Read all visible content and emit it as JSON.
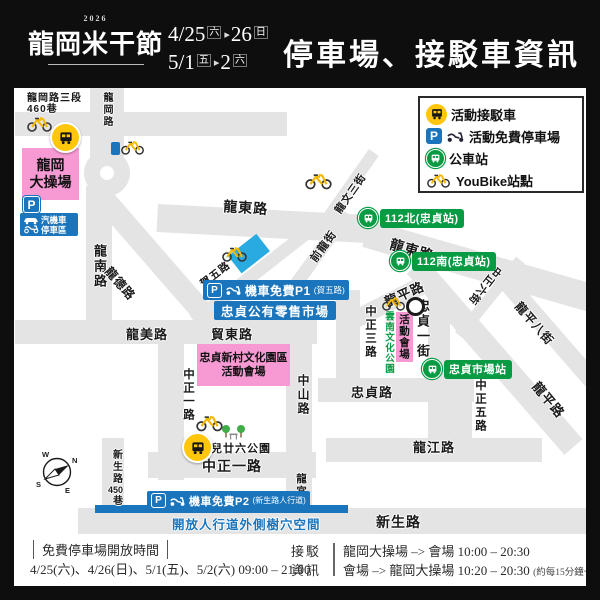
{
  "header": {
    "year": "2026",
    "logo": "龍岡米干節",
    "title": "停車場、接駁車資訊",
    "dates": [
      {
        "d1": "4/25",
        "w1": "六",
        "sep": "▸",
        "d2": "26",
        "w2": "日"
      },
      {
        "d1": "5/1",
        "w1": "五",
        "sep": "▸",
        "d2": "2",
        "w2": "六"
      }
    ]
  },
  "legend": {
    "items": [
      {
        "icon": "shuttle-bus-icon",
        "label": "活動接駁車"
      },
      {
        "icon": "parking-icon",
        "label": "活動免費停車場"
      },
      {
        "icon": "city-bus-icon",
        "label": "公車站"
      },
      {
        "icon": "youbike-icon",
        "label": "YouBike站點"
      }
    ]
  },
  "map": {
    "labels": [
      {
        "text": "龍岡路三段\n460巷"
      },
      {
        "text": "龍岡路"
      },
      {
        "text": "龍南路"
      },
      {
        "text": "龍德路"
      },
      {
        "text": "龍美路"
      },
      {
        "text": "貿東路"
      },
      {
        "text": "賀五路"
      },
      {
        "text": "龍東路"
      },
      {
        "text": "龍東路"
      },
      {
        "text": "前龍街"
      },
      {
        "text": "龍文三街"
      },
      {
        "text": "龍平路"
      },
      {
        "text": "龍平路"
      },
      {
        "text": "龍平八街"
      },
      {
        "text": "中正六街"
      },
      {
        "text": "忠貞一街"
      },
      {
        "text": "中正三路"
      },
      {
        "text": "雲南文化公園"
      },
      {
        "text": "中正五路"
      },
      {
        "text": "忠貞路"
      },
      {
        "text": "龍江路"
      },
      {
        "text": "中山路"
      },
      {
        "text": "中正一路"
      },
      {
        "text": "中正一路"
      },
      {
        "text": "龍宮街"
      },
      {
        "text": "新生路",
        "num": "450",
        "tail": "巷"
      },
      {
        "text": "新生路"
      },
      {
        "text": "兒廿六公園"
      }
    ],
    "badges": [
      {
        "label": "112北(忠貞站)"
      },
      {
        "label": "112南(忠貞站)"
      },
      {
        "label": "忠貞市場站"
      }
    ],
    "areas": {
      "ground": "龍岡\n大操場",
      "vehicle_park": "汽機車\n停車區",
      "culture": "忠貞新村文化園區\n活動會場",
      "venue": "活動會場"
    },
    "banners": {
      "p_letter": "P",
      "p1": "機車免費P1",
      "p1_sub": "(賀五路)",
      "market": "忠貞公有零售市場",
      "p2": "機車免費P2",
      "p2_sub": "(新生路人行道)",
      "sidewalk": "開放人行道外側樹穴空間"
    },
    "compass": {
      "n": "N",
      "e": "E",
      "s": "S",
      "w": "W"
    }
  },
  "footer": {
    "open_title": "免費停車場開放時間",
    "open_hours": "4/25(六)、4/26(日)、5/1(五)、5/2(六) 09:00 – 21:00",
    "left_label_top": "接駁",
    "left_label_bottom": "資訊",
    "row1": "龍岡大操場 –> 會場  10:00 – 20:30",
    "row2": "會場 –> 龍岡大操場  10:20 – 20:30",
    "note": "(約每15分鐘一班車)"
  },
  "colors": {
    "blue": "#1b75bc",
    "pink": "#f79ad3",
    "green": "#089b44",
    "yellow": "#ffc60b",
    "light_blue": "#29abe2",
    "road": "#e4e4e5"
  }
}
